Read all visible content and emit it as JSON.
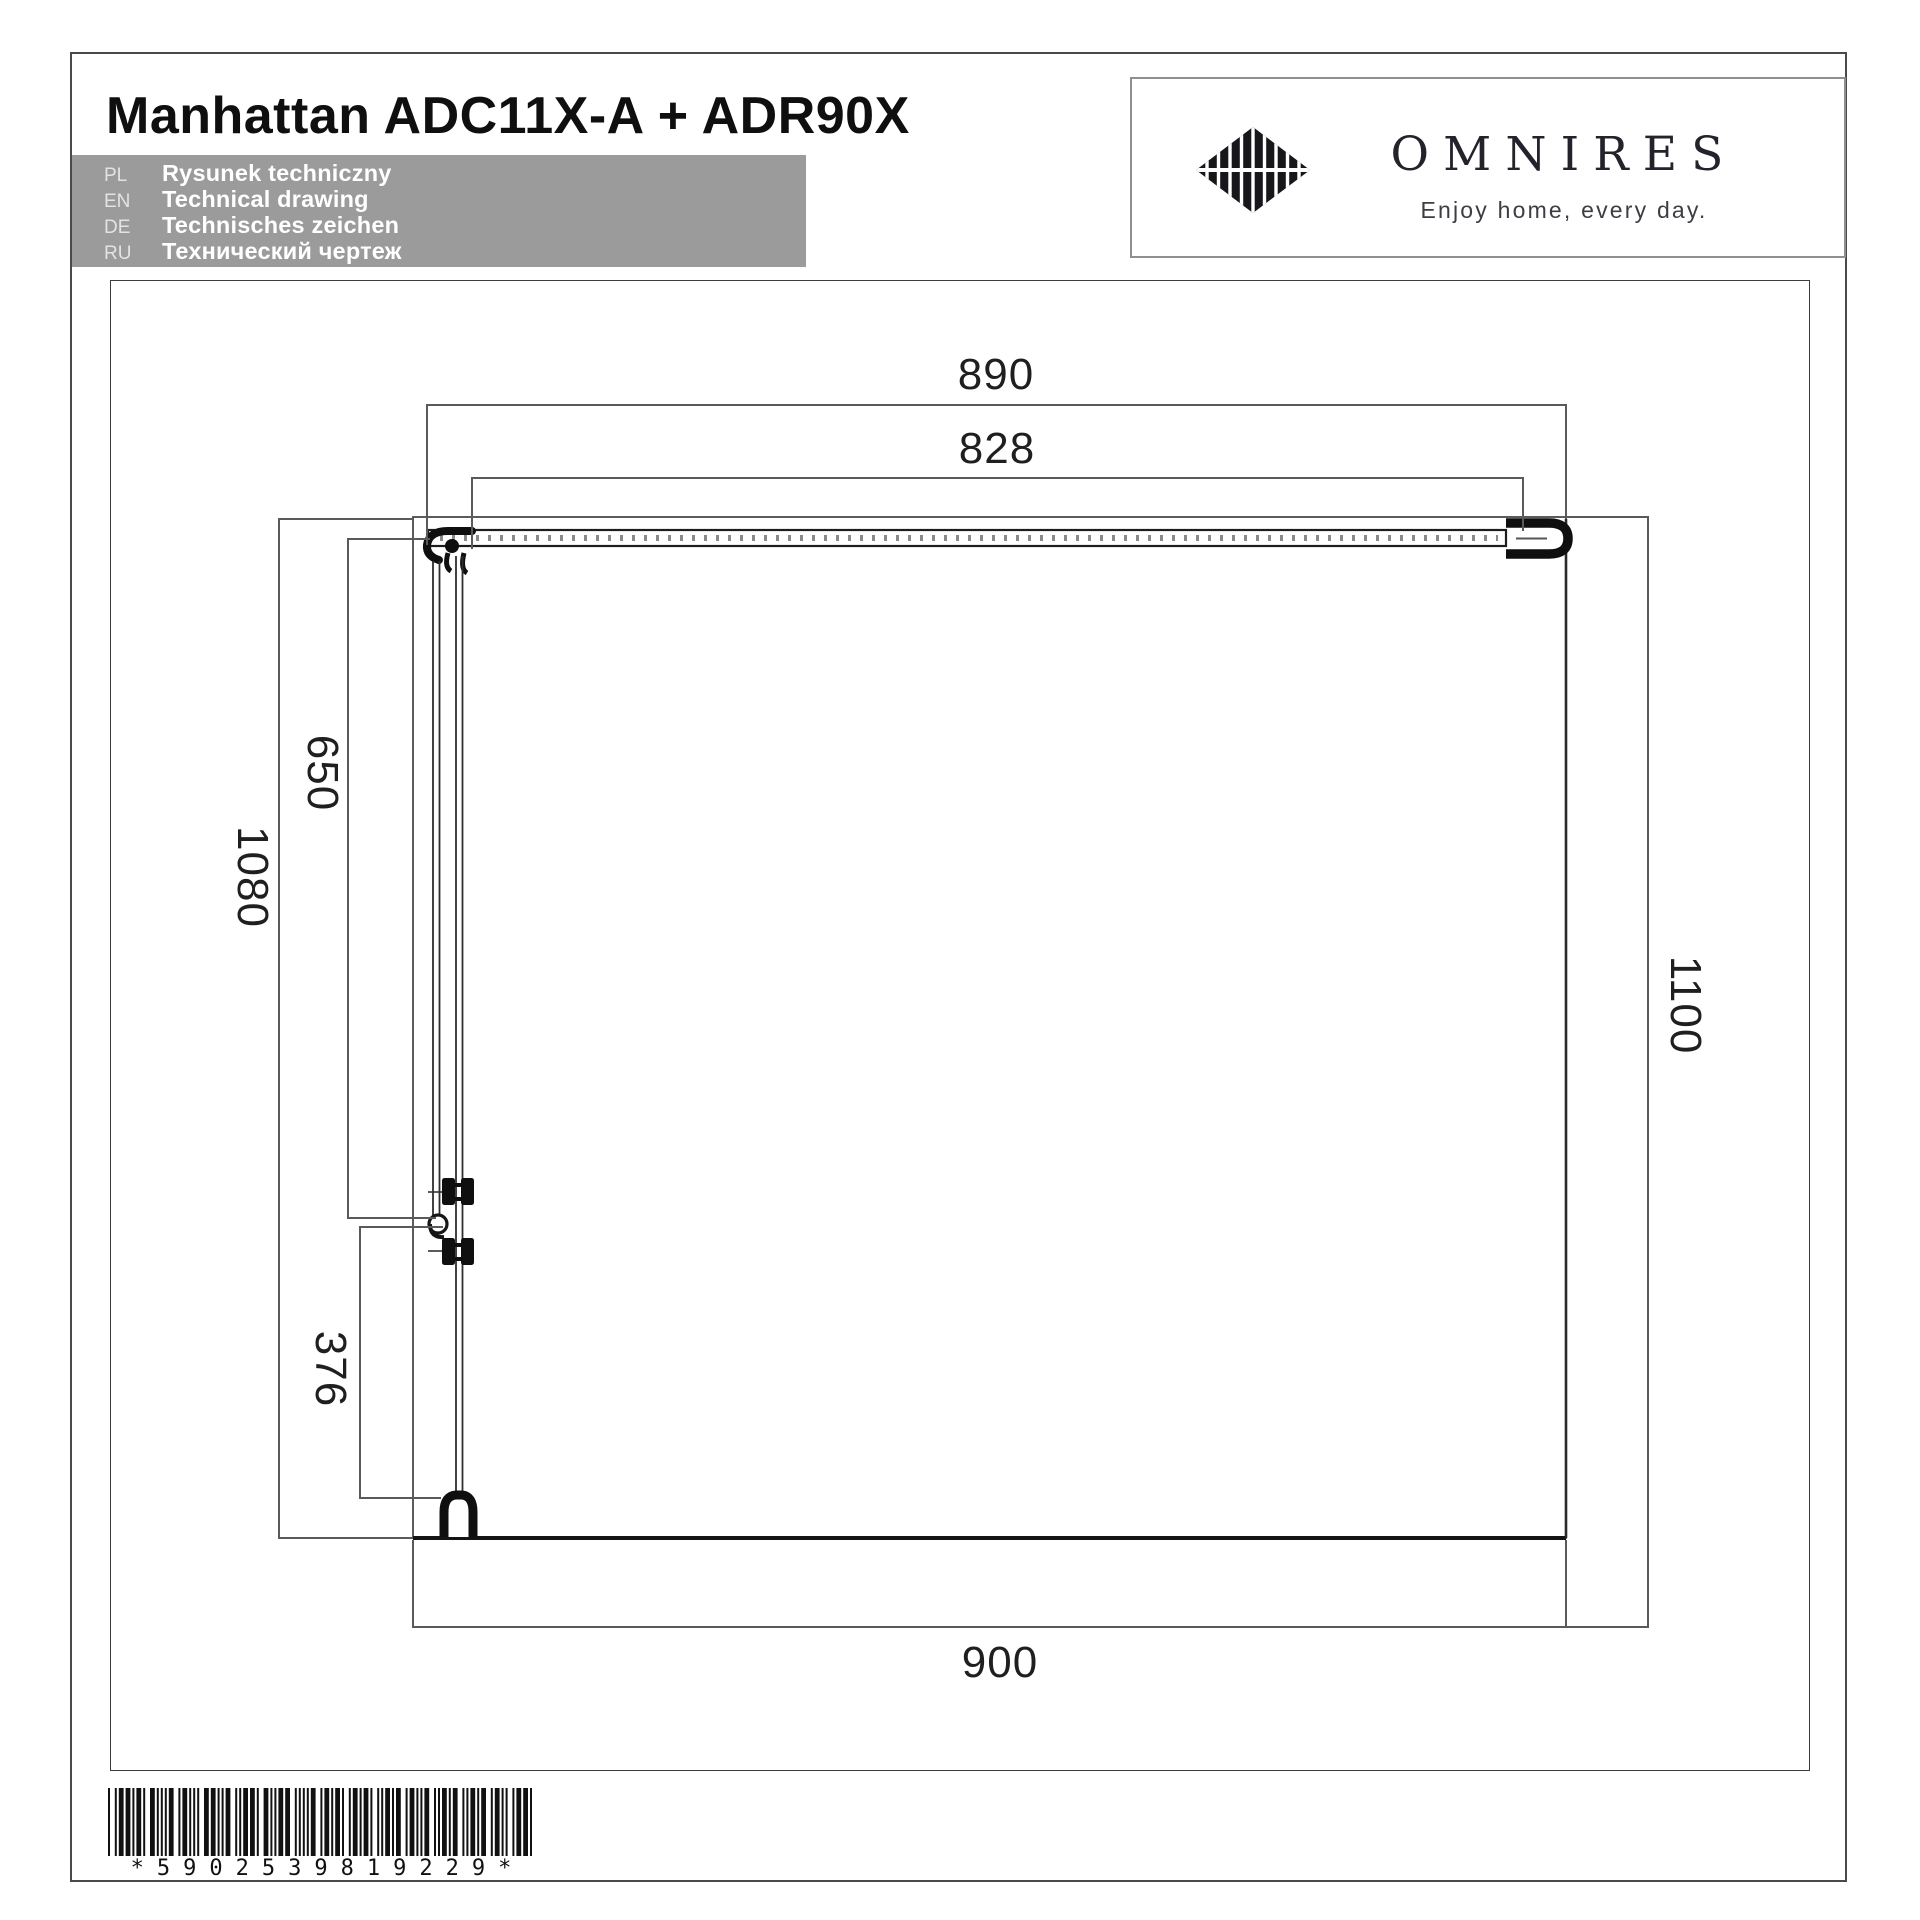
{
  "header": {
    "title": "Manhattan ADC11X-A + ADR90X",
    "languages": [
      {
        "code": "PL",
        "label": "Rysunek techniczny"
      },
      {
        "code": "EN",
        "label": "Technical drawing"
      },
      {
        "code": "DE",
        "label": "Technisches zeichen"
      },
      {
        "code": "RU",
        "label": "Технический чертеж"
      }
    ]
  },
  "logo": {
    "brand": "OMNIRES",
    "tagline": "Enjoy home, every day.",
    "mark_icon": "diamond-striped-logo"
  },
  "drawing": {
    "description": "Top view technical drawing of corner shower enclosure",
    "dimensions": {
      "top_outer": "890",
      "top_inner": "828",
      "left_upper": "650",
      "left_full": "1080",
      "left_lower": "376",
      "right_full": "1100",
      "bottom": "900"
    }
  },
  "barcode": {
    "text": "*5902539819229*",
    "digits": "5902539819229"
  },
  "colors": {
    "lang_box_bg": "#9b9b9b",
    "object_line": "#141414",
    "dimension_line": "#5a5a5a",
    "brand_text": "#23232b"
  }
}
